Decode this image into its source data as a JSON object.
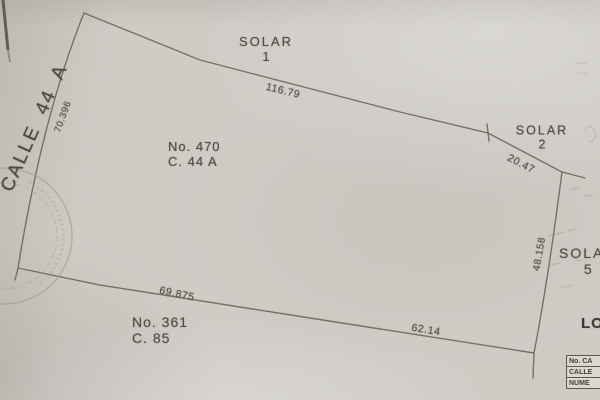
{
  "plan": {
    "street_label": "CALLE 44 A",
    "solar_top": {
      "name": "SOLAR",
      "num": "1"
    },
    "solar_right": {
      "name": "SOLAR",
      "num": "2"
    },
    "solar_lower_right": {
      "name": "SOLAR",
      "num": "5"
    },
    "lot_main": {
      "line1": "No. 470",
      "line2": "C. 44 A"
    },
    "lot_south": {
      "line1": "No. 361",
      "line2": "C. 85"
    },
    "dims": {
      "top": "116.79",
      "top_right": "20.47",
      "right": "48.158",
      "left": "70.396",
      "bottom_left": "69.875",
      "bottom_right": "62.14"
    }
  },
  "corner": {
    "title_partial": "LO",
    "table_rows": [
      "No. CA",
      "CALLE",
      "NUME"
    ]
  },
  "colors": {
    "paper": "#cfccc6",
    "ink": "#554f48",
    "boundary_line": "#6f695f",
    "stamp": "#a29b90"
  }
}
